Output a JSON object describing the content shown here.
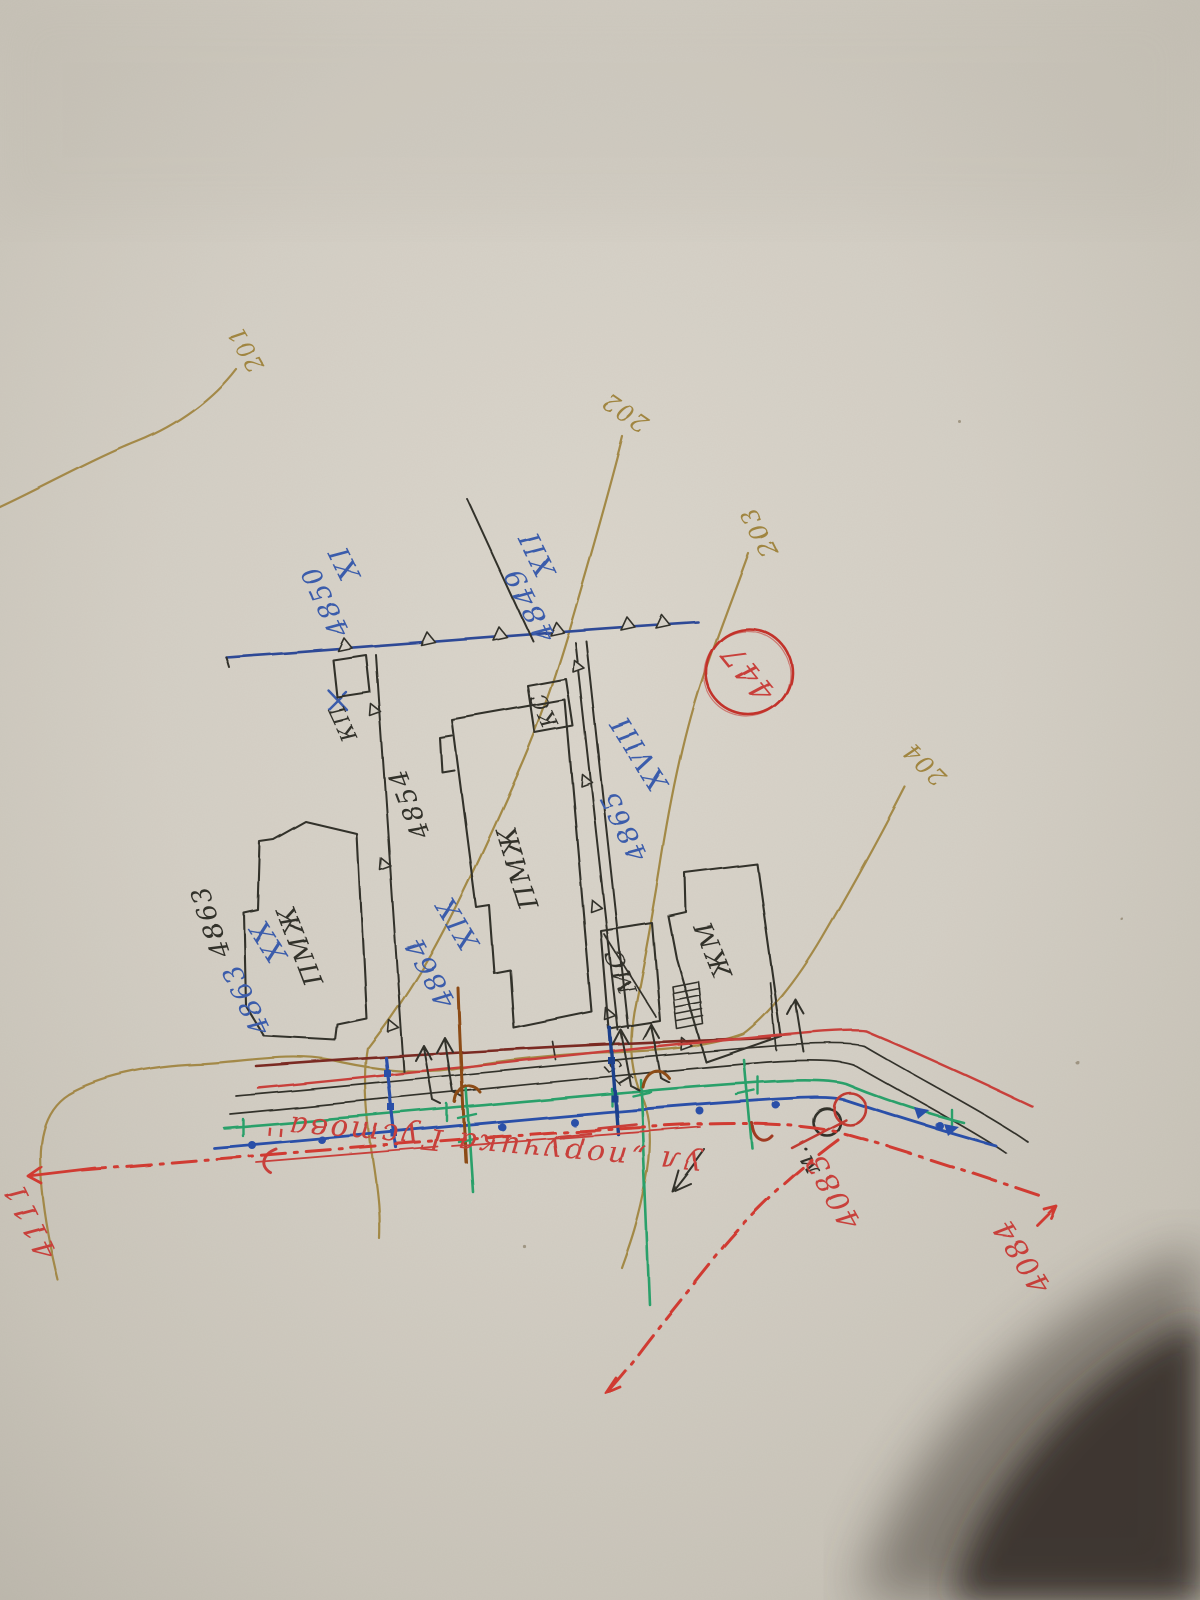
{
  "figure_type": "photo of hand-drawn cadastral site plan, rotated 180°",
  "contours": {
    "c201": "201",
    "c202": "202",
    "c203": "203",
    "c204": "204"
  },
  "plots": {
    "xi": "XI",
    "xi_num": "4850",
    "xii": "XII",
    "xii_num": "4849",
    "xviii": "XVIII",
    "xviii_num": "4865",
    "xix": "XIX",
    "xix_num": "4864",
    "xx": "XX",
    "xx_num": "4863"
  },
  "parcel_numbers": {
    "n4854": "4854",
    "n4863": "4863"
  },
  "buildings": {
    "pmzh_left": "ПМЖ",
    "pmzh_mid": "ПМЖ",
    "ms": "МС",
    "zhm": "ЖМ",
    "ks": "КС",
    "kp": "КП"
  },
  "stamp": {
    "number": "447"
  },
  "street": {
    "name": "ул „поручика Густова''"
  },
  "red_marks": {
    "n4083": "4083",
    "n4084": "4084",
    "n4111": "4111"
  },
  "notes": {
    "g5": "Г5",
    "m": "м."
  },
  "colors": {
    "paper": "#d5d0c6",
    "black_ink": "#33302b",
    "blue_ink": "#3a5cab",
    "red_ink": "#c8403a",
    "olive_contour": "#a08540",
    "green_utility": "#2aa06b",
    "maroon_utility": "#7a2a22",
    "brown_utility": "#8c4c16"
  }
}
